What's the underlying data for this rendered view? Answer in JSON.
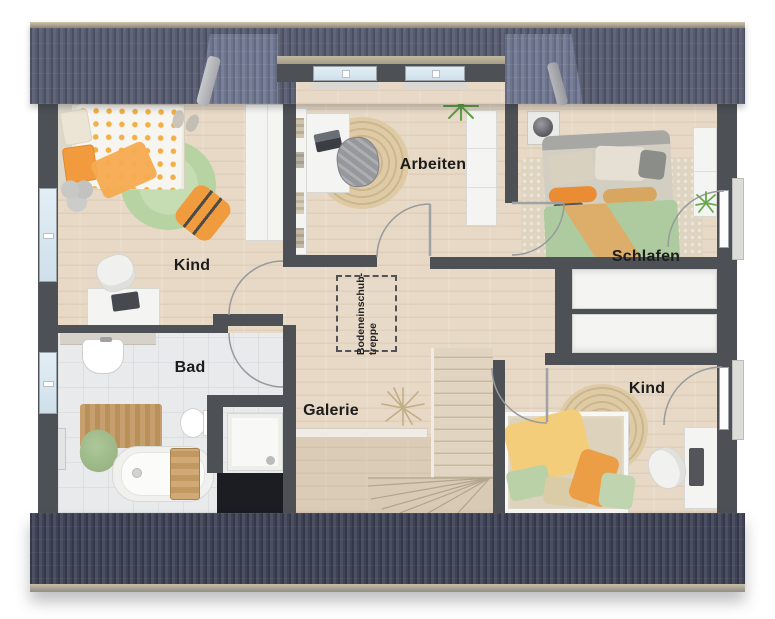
{
  "plan": {
    "rooms": {
      "kind_left": {
        "label": "Kind"
      },
      "arbeiten": {
        "label": "Arbeiten"
      },
      "schlafen": {
        "label": "Schlafen"
      },
      "bad": {
        "label": "Bad"
      },
      "galerie": {
        "label": "Galerie"
      },
      "kind_right": {
        "label": "Kind"
      }
    },
    "attic_hatch": {
      "line1": "Bodeneinschub-",
      "line2": "treppe"
    },
    "colors": {
      "roof_top": "#575c6f",
      "roof_top_dark": "#4a4f61",
      "roof_slope": "#6e7489",
      "roof_ridge": "#a99f8a",
      "roof_bottom": "#3e4254",
      "roof_bottom_dark": "#343849",
      "gutter": "#c7bea7",
      "wall": "#4d5156",
      "wood": "#e7d9c6",
      "wood_dark": "#d9c8b2",
      "tile": "#e9eaec",
      "rug_green": "#b7d3a1",
      "jute": "#d7c29c",
      "orange": "#f0a03f",
      "duvet_green": "#aecba0",
      "yellow": "#f3cd7a",
      "white_furniture": "#f4f4f2",
      "glass": "#cfe0eb",
      "label": "#1c1c1c"
    }
  }
}
